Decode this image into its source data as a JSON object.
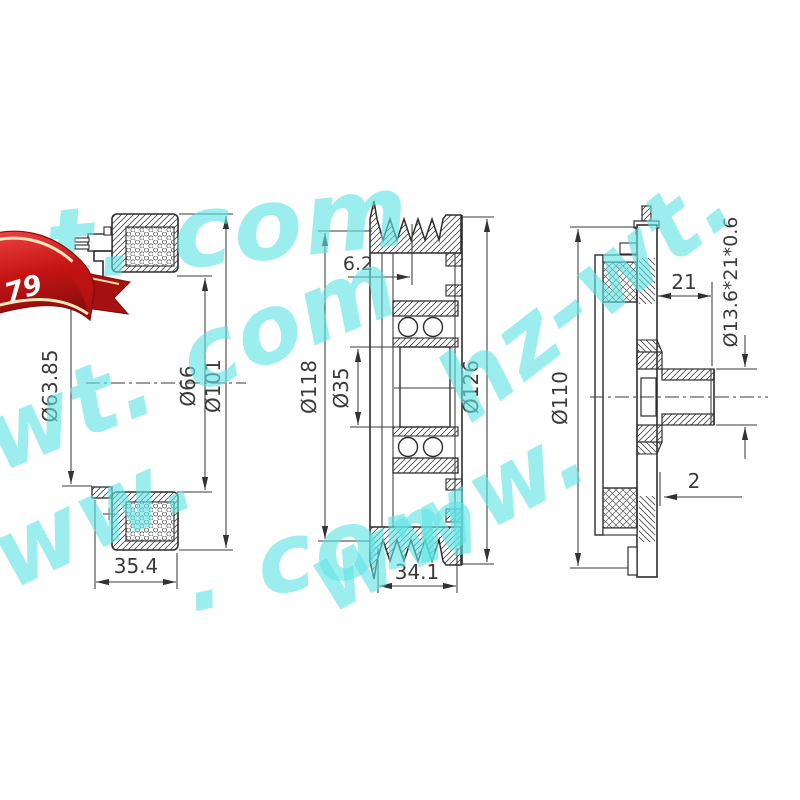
{
  "watermark": {
    "text": "www.hz-wt.com",
    "color": "#5fe3e3",
    "fragments": [
      "t. com",
      "-wt. com",
      "www.",
      "hz-wt.",
      ". com",
      "www."
    ]
  },
  "badge": {
    "number": "79",
    "color_main": "#cf1616",
    "color_dark": "#a61212",
    "color_trim": "#f6e7bd",
    "text_color": "#ffffff"
  },
  "drawing": {
    "subject": "AC compressor clutch assembly - three section views",
    "line_color": "#2d2d2d",
    "views": {
      "coil": {
        "label": "field coil section",
        "dims": {
          "bore": "Ø63.85",
          "inner": "Ø66",
          "outer": "Ø101",
          "width": "35.4"
        }
      },
      "pulley": {
        "label": "pulley with bearing section",
        "dims": {
          "groove_offset": "6.2",
          "groove_dia": "Ø118",
          "bore": "Ø35",
          "outer": "Ø126",
          "width": "34.1"
        }
      },
      "hub": {
        "label": "hub plate section",
        "dims": {
          "outer": "Ø110",
          "hub_length": "21",
          "bearing": "Ø13.6*21*0.6",
          "gap": "2"
        }
      }
    }
  }
}
